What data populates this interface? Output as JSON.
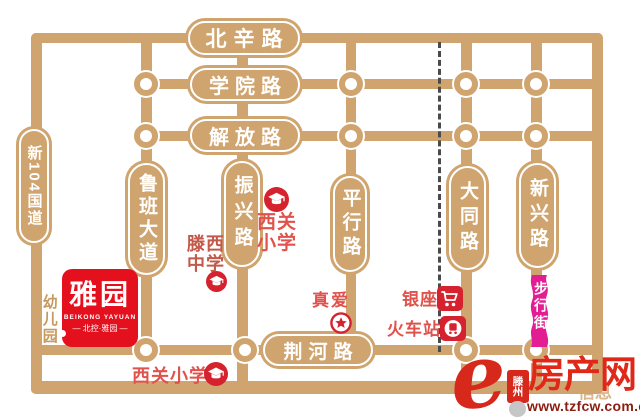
{
  "map": {
    "roads": {
      "beixin": "北辛路",
      "xueyuan": "学院路",
      "jiefang": "解放路",
      "jinghe": "荆河路",
      "g104": "新104国道",
      "luban": "鲁班大道",
      "zhenxing": "振兴路",
      "pingxing": "平行路",
      "datong": "大同路",
      "xinxing": "新兴路",
      "pedestrian": "步行街"
    },
    "landmarks": {
      "xiguan_north": {
        "line1": "西关",
        "line2": "小学"
      },
      "tengxi": {
        "line1": "滕西",
        "line2": "中学"
      },
      "zhenai": {
        "label": "真爱"
      },
      "yinzuo": {
        "label": "银座"
      },
      "station": {
        "label": "火车站"
      },
      "kindergarten": {
        "label": "幼儿园"
      },
      "xiguan_south": {
        "label": "西关小学"
      }
    },
    "project": {
      "title": "雅园",
      "subtitle": "BEIKONG YAYUAN",
      "tagline": "— 北控·雅园 —"
    }
  },
  "watermark": {
    "logo_letter": "e",
    "city": "滕州",
    "site": "房产网",
    "faint": "信息",
    "url": "www.tzfcw.com.cn"
  },
  "colors": {
    "road": "#D0A46E",
    "pedestrian_pink": "#E31E93",
    "landmark_red": "#E2524C",
    "icon_red": "#D6212E",
    "brand_red": "#E5101E",
    "watermark_red": "#E02718",
    "url_red": "#8C1D12",
    "kindergarten_tan": "#C69A5F",
    "railway_gray": "#4A4A4A"
  }
}
